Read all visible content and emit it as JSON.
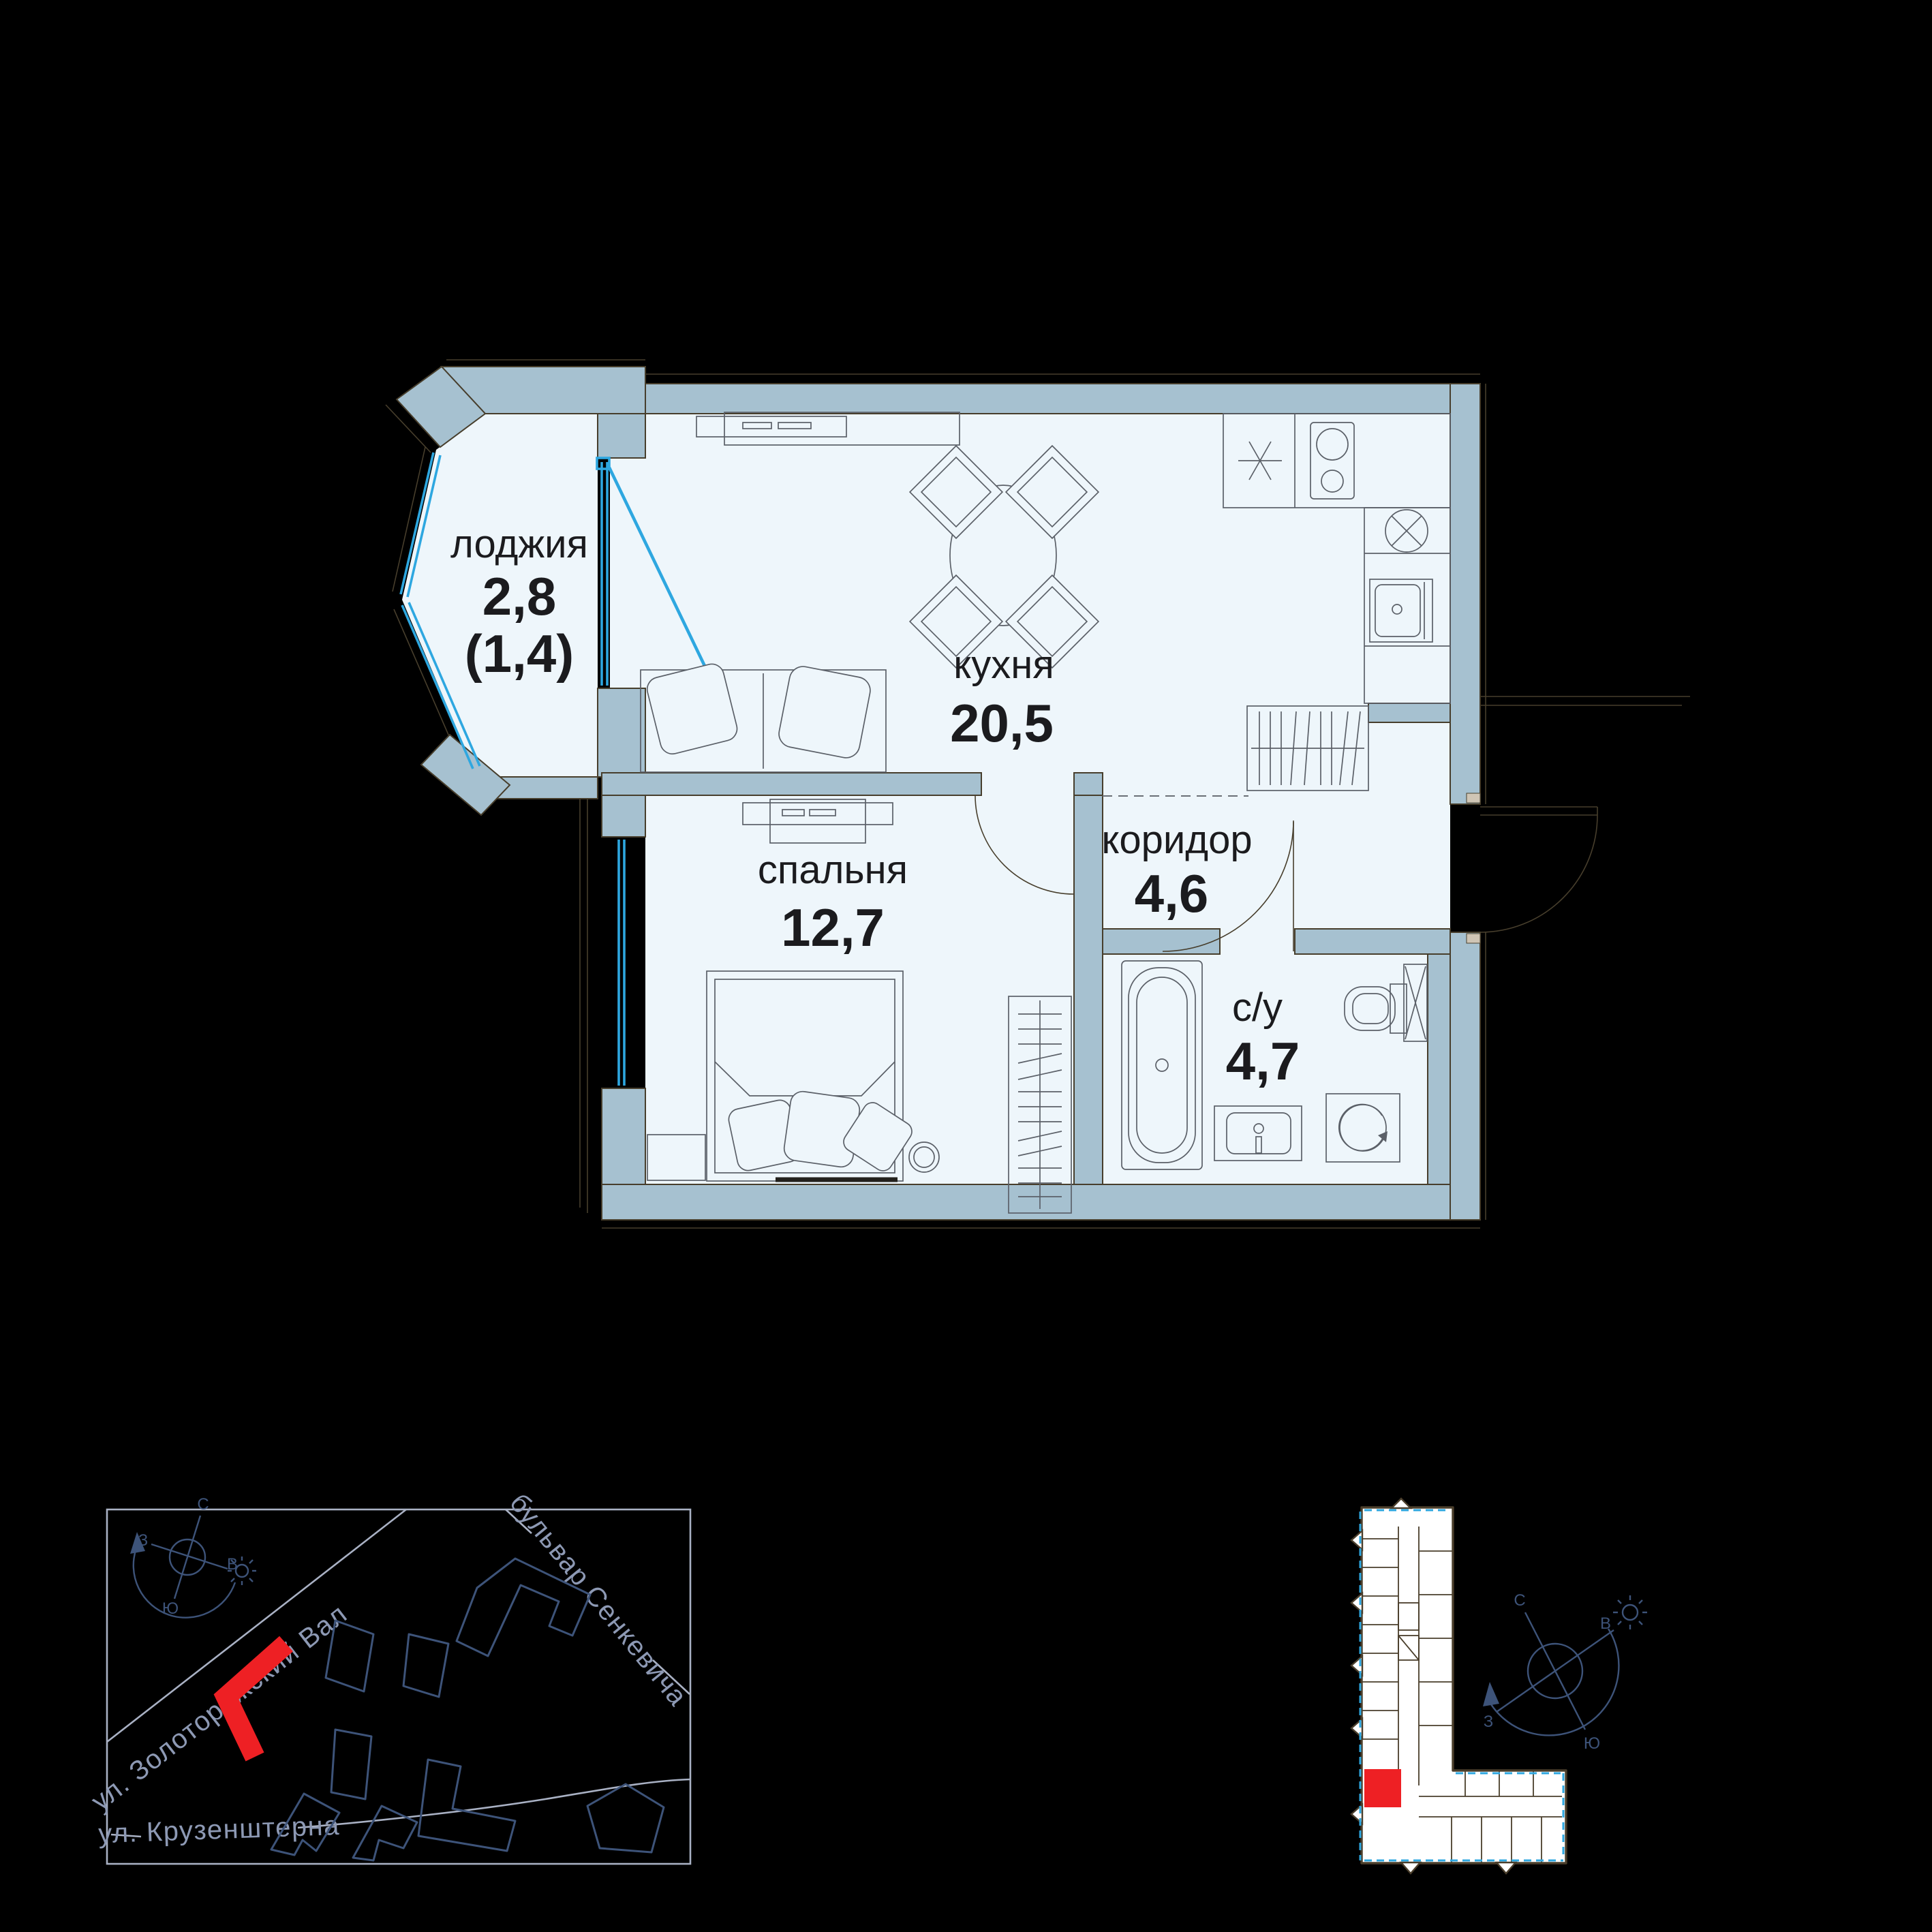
{
  "colors": {
    "background": "#000000",
    "wall_fill": "#a6c1d0",
    "outline": "#473e2c",
    "floor_fill": "#eef6fb",
    "window_blue": "#2ea7e0",
    "furniture_line": "#5b6068",
    "label_ink": "#1b1b1e",
    "map_navy": "#3d5379",
    "street_line": "#a9b1c4",
    "street_text": "#8d99b4",
    "highlight_red": "#ee2024",
    "mini_outline": "#4a3e2b"
  },
  "plan": {
    "rooms": [
      {
        "id": "loggia",
        "name": "лоджия",
        "area": "2,8",
        "area_reduced": "(1,4)"
      },
      {
        "id": "kitchen",
        "name": "кухня",
        "area": "20,5"
      },
      {
        "id": "bedroom",
        "name": "спальня",
        "area": "12,7"
      },
      {
        "id": "corridor",
        "name": "коридор",
        "area": "4,6"
      },
      {
        "id": "bathroom",
        "name": "с/у",
        "area": "4,7"
      }
    ]
  },
  "site_map": {
    "streets": [
      {
        "name": "ул. Золоторожский Вал"
      },
      {
        "name": "бульвар Сенкевича"
      },
      {
        "name": "ул. Крузенштерна"
      }
    ],
    "compass": {
      "north": "С",
      "east": "В",
      "west": "З",
      "south": "Ю"
    }
  },
  "floor_overview": {
    "compass": {
      "north": "С",
      "east": "В",
      "west": "З",
      "south": "Ю"
    }
  }
}
